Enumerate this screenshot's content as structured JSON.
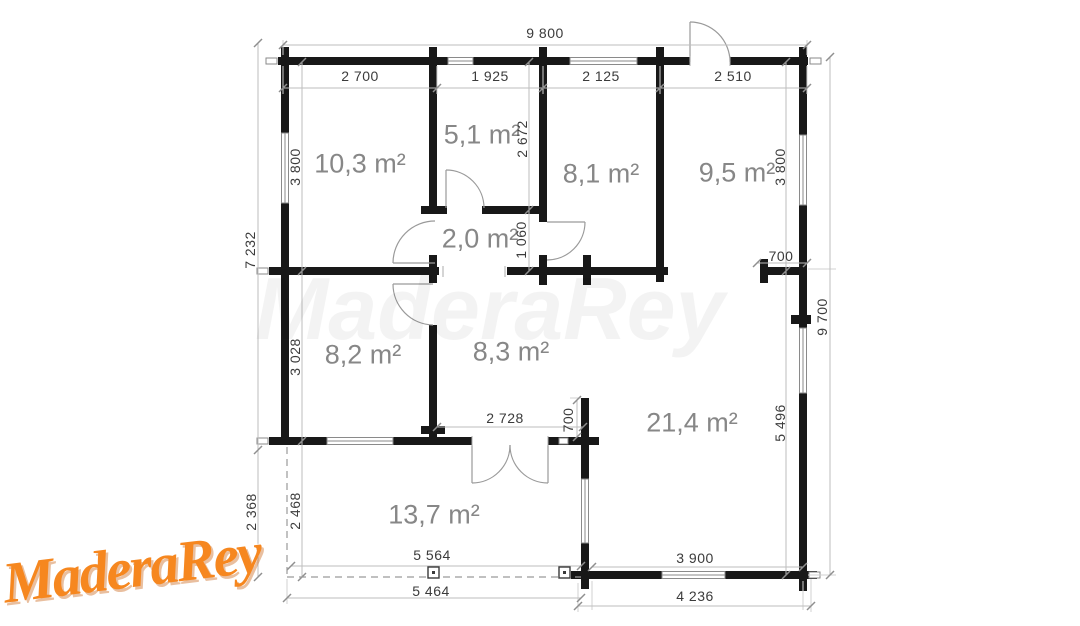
{
  "brand": {
    "logo_text": "MaderaRey",
    "watermark_text": "MaderaRey",
    "logo_color": "#f6871f"
  },
  "rooms": {
    "room_top_left": "10,3 m²",
    "room_top_mid": "5,1 m²",
    "room_top_right": "8,1 m²",
    "room_far_right": "9,5 m²",
    "hallway": "2,0 m²",
    "room_mid_left": "8,2 m²",
    "room_mid_center": "8,3 m²",
    "living_room": "21,4 m²",
    "terrace": "13,7 m²"
  },
  "dimensions": {
    "top_total": "9 800",
    "top_seg1": "2 700",
    "top_seg2": "1 925",
    "top_seg3": "2 125",
    "top_seg4": "2 510",
    "left_total": "7 232",
    "left_upper": "3 800",
    "left_lower": "3 028",
    "terrace_left_outer": "2 368",
    "terrace_left_inner": "2 468",
    "hall_upper": "2 672",
    "hall_height": "1 060",
    "right_upper": "3 800",
    "right_stub": "700",
    "right_lower": "5 496",
    "right_total": "9 700",
    "patio_door_width": "2 728",
    "patio_side": "700",
    "terrace_width_inner": "5 564",
    "terrace_width_outer": "5 464",
    "bottom_inner": "3 900",
    "bottom_outer": "4 236"
  }
}
